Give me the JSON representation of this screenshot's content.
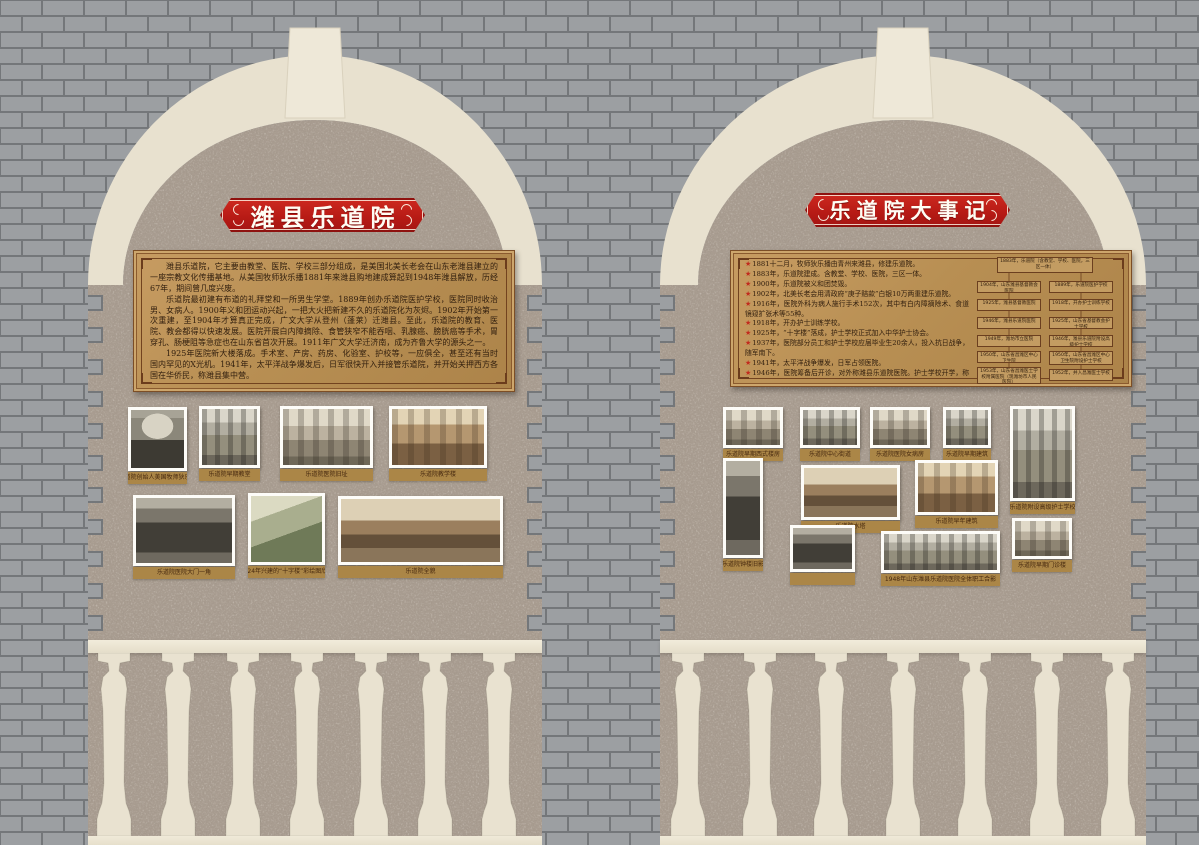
{
  "left_panel": {
    "title": "潍县乐道院",
    "plaque_paragraphs": [
      "潍县乐道院，它主要由教堂、医院、学校三部分组成，是美国北美长老会在山东老潍县建立的一座宗教文化传播基地。从美国牧师狄乐播1881年来潍县购地建成算起到1948年潍县解放，历经67年，期间曾几度兴废。",
      "乐道院最初建有布道的礼拜堂和一所男生学堂。1889年创办乐道院医护学校，医院同时收治男、女病人。1900年义和团运动兴起，一把大火把新建不久的乐道院化为灰烬。1902年开始第一次重建，至1904年才算真正完成，广文大学从登州（蓬莱）迁潍县。至此，乐道院的教育、医院、教会都得以快速发展。医院开展白内障摘除、食管狭窄不能吞咽、乳腺癌、膀胱癌等手术，胃穿孔、肠梗阻等急症也在山东省首次开展。1911年广文大学迁济南，成为齐鲁大学的源头之一。",
      "1925年医院新大楼落成。手术室、产房、药房、化验室、护校等，一应俱全，甚至还有当时国内罕见的X光机。1941年，太平洋战争爆发后，日军很快开入并接管乐道院，并开始关押西方各国在华侨民，称潍县集中营。",
      "1948年潍县全面解放，医院由潍坊特别市接管，并挂牌更名为“潍坊特别市乐道院医院”，1949年，医院更名为“潍坊特别市市立医院”。1950年更名为山东省昌潍区中心卫生院，其附设护士学校更名为昌潍专区中心卫生院附设护士学校，护士学校后并于山东昌潍医士学校。"
    ],
    "photo_captions": [
      "乐道院创始人美国牧师狄乐播",
      "乐道院早期教堂",
      "乐道院医院旧址",
      "乐道院教学楼",
      "乐道院医院大门一角",
      "1924年兴建的“十字楼”彩绘图欣赏",
      "乐道院全貌"
    ]
  },
  "right_panel": {
    "title": "乐道院大事记",
    "timeline_bullet": "★",
    "timeline": [
      "1881十二月，牧师狄乐播由青州来潍县，修建乐道院。",
      "1883年，乐道院建成。含教堂、学校、医院，三区一体。",
      "1900年，乐道院被义和团焚毁。",
      "1902年，北美长老会用清政府“庚子赔款”白银10万两重建乐道院。",
      "1916年，医院外科为病人施行手术152次，其中有白内障摘除术、食道镜窥扩张术等55种。",
      "1918年，开办护士训练学校。",
      "1925年，“十字楼”落成，护士学校正式加入中华护士协会。",
      "1937年，医院部分员工和护士学校应届毕业生20余人，投入抗日战争，随军南下。",
      "1941年，太平洋战争爆发，日军占领医院。",
      "1946年，医院筹备后开诊，对外称潍县乐道院医院。护士学校开学，称潍县乐道院附设高级护士学校。",
      "1949年，潍坊特别市政府发布文件，正式接管医院，筹建“潍坊特别市市立医院附设专门学校”开学。",
      "1952年，护士学校并入昌潍医士学校。"
    ],
    "flowchart_boxes": [
      "1883年，乐道院（含教堂、学校、医院，三区一体）",
      "1904年，山东潍县基督教会医院",
      "1925年，潍县基督教医院",
      "1946年，潍县乐道院医院",
      "1949年，潍坊市立医院",
      "1950年，山东省昌潍区中心卫生院",
      "1953年，山东省昌潍医士学校附属医院（现潍坊市人民医院）",
      "1889年，乐道院医护学校",
      "1918年，开办护士训练学校",
      "1925年，山东省基督教会护士学校",
      "1946年，潍县乐道院附设高级护士学校",
      "1950年，山东省昌潍区中心卫生院附设护士学校",
      "1952年，并入昌潍医士学校"
    ],
    "photo_captions": [
      "乐道院早期西式楼房",
      "乐道院中心街道",
      "乐道院医院女病房",
      "乐道院早期建筑",
      "乐道院附设高级护士学校",
      "乐道院早期门诊楼",
      "乐道院钟楼旧影",
      "乐道院水塔",
      "乐道院早年建筑",
      "",
      "1948年山东潍县乐道院医院全体职工合影"
    ]
  },
  "colors": {
    "banner_red": "#b61a15",
    "plaque_tan": "#b88f53",
    "caption_tan": "#ab8647",
    "cream": "#e8e1cf",
    "stucco": "#a99d91",
    "brick": "#9c9fa2",
    "mortar": "#74777a",
    "star_red": "#c22a1d",
    "text_brown": "#33200f"
  }
}
